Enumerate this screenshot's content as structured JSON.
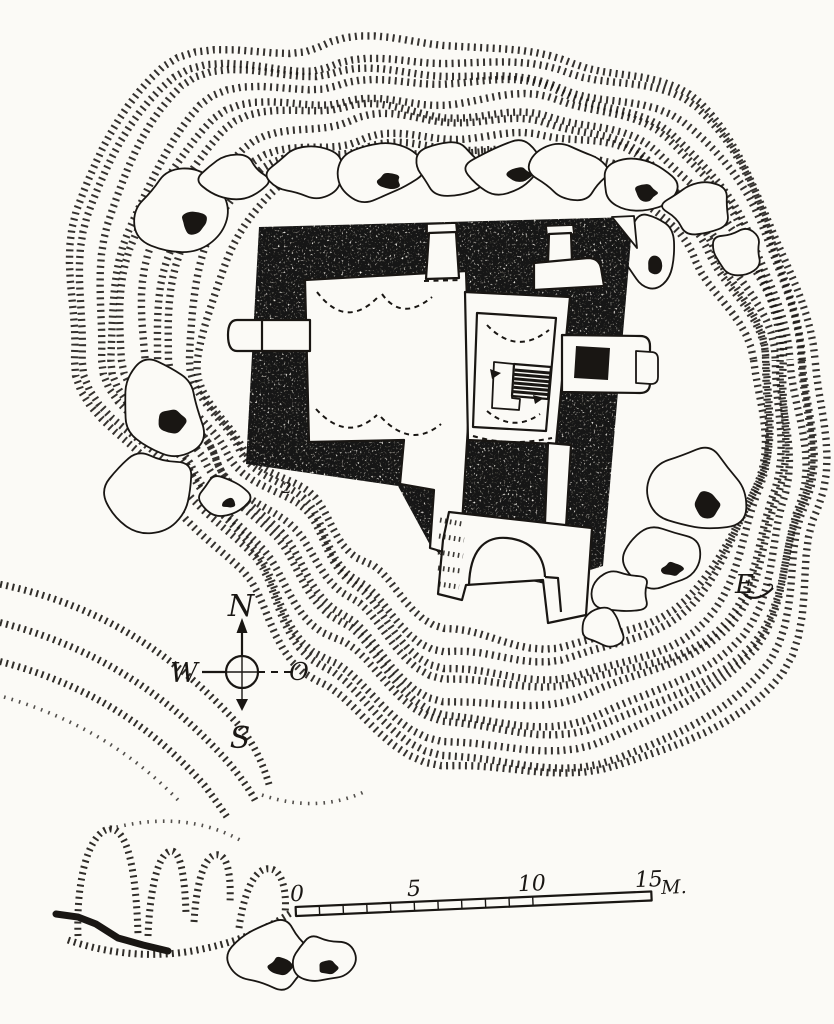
{
  "palette": {
    "paper": "#fbfaf6",
    "ink": "#191613"
  },
  "compass": {
    "north": "N",
    "east": "O",
    "south": "S",
    "west": "W"
  },
  "scale_bar": {
    "labels": [
      "0",
      "5",
      "10",
      "15"
    ],
    "unit": "M.",
    "total_m": 15
  },
  "annotations": {
    "site_label": "2",
    "monogram": "E"
  },
  "map_data": {
    "rings": {
      "cx": 450,
      "cy": 360,
      "count": 10,
      "inner": [
        300,
        322,
        328,
        300,
        268,
        210,
        185,
        215,
        245,
        240,
        235,
        205,
        192,
        212,
        240,
        265
      ],
      "outer": [
        368,
        400,
        466,
        452,
        425,
        358,
        305,
        315,
        390,
        420,
        430,
        350,
        318,
        332,
        370,
        362
      ]
    },
    "terrace": [
      {
        "c": "hach",
        "d": "M -6 583 C 90 602 165 645 236 722 C 252 740 263 762 270 788"
      },
      {
        "c": "hach",
        "d": "M -6 621 C 85 643 162 688 228 762 C 240 776 250 790 256 802"
      },
      {
        "c": "hach",
        "d": "M -6 660 C 75 680 145 718 205 786 C 213 797 221 808 227 817"
      },
      {
        "c": "dot",
        "d": "M 4 697 C 65 715 125 745 178 800"
      },
      {
        "c": "dot",
        "d": "M 262 795 C 300 808 336 806 368 790"
      },
      {
        "c": "hach",
        "d": "M 78 936 C 76 876 90 832 109 829 C 128 827 136 872 138 934"
      },
      {
        "c": "hach",
        "d": "M 148 936 C 150 886 159 852 171 851 C 181 850 185 880 186 914"
      },
      {
        "c": "hach",
        "d": "M 194 922 C 197 874 207 852 219 855 C 229 857 231 882 230 902"
      },
      {
        "c": "hach",
        "d": "M 239 928 C 245 886 257 866 271 869 C 283 871 287 894 285 914"
      },
      {
        "c": "hach",
        "d": "M 68 940 C 108 954 152 958 192 951 C 232 944 262 932 292 912"
      },
      {
        "c": "dot",
        "d": "M 109 829 C 150 818 196 816 240 840"
      },
      {
        "c": "blk",
        "d": "M 56 914 L 78 917 L 96 924 L 118 938 L 143 945 L 168 951"
      }
    ],
    "boulders": [
      {
        "cx": 182,
        "cy": 210,
        "rx": 48,
        "ry": 42,
        "seed": 11,
        "dark": true
      },
      {
        "cx": 236,
        "cy": 180,
        "rx": 34,
        "ry": 24,
        "seed": 22,
        "dark": false
      },
      {
        "cx": 305,
        "cy": 174,
        "rx": 36,
        "ry": 26,
        "seed": 33,
        "dark": false
      },
      {
        "cx": 378,
        "cy": 172,
        "rx": 42,
        "ry": 30,
        "seed": 44,
        "dark": true
      },
      {
        "cx": 448,
        "cy": 167,
        "rx": 38,
        "ry": 27,
        "seed": 55,
        "dark": false
      },
      {
        "cx": 509,
        "cy": 166,
        "rx": 40,
        "ry": 29,
        "seed": 66,
        "dark": true
      },
      {
        "cx": 573,
        "cy": 172,
        "rx": 40,
        "ry": 28,
        "seed": 77,
        "dark": false
      },
      {
        "cx": 636,
        "cy": 184,
        "rx": 38,
        "ry": 30,
        "seed": 88,
        "dark": true
      },
      {
        "cx": 697,
        "cy": 206,
        "rx": 34,
        "ry": 28,
        "seed": 99,
        "dark": false
      },
      {
        "cx": 737,
        "cy": 251,
        "rx": 26,
        "ry": 22,
        "seed": 110,
        "dark": false
      },
      {
        "cx": 648,
        "cy": 255,
        "rx": 25,
        "ry": 36,
        "seed": 112,
        "dark": true
      },
      {
        "cx": 160,
        "cy": 405,
        "rx": 48,
        "ry": 50,
        "seed": 121,
        "dark": true
      },
      {
        "cx": 152,
        "cy": 490,
        "rx": 42,
        "ry": 40,
        "seed": 132,
        "dark": false
      },
      {
        "cx": 223,
        "cy": 497,
        "rx": 25,
        "ry": 20,
        "seed": 143,
        "dark": true
      },
      {
        "cx": 694,
        "cy": 490,
        "rx": 52,
        "ry": 48,
        "seed": 154,
        "dark": true
      },
      {
        "cx": 664,
        "cy": 560,
        "rx": 36,
        "ry": 30,
        "seed": 165,
        "dark": true
      },
      {
        "cx": 621,
        "cy": 593,
        "rx": 30,
        "ry": 24,
        "seed": 176,
        "dark": false
      },
      {
        "cx": 271,
        "cy": 956,
        "rx": 40,
        "ry": 34,
        "seed": 187,
        "dark": true
      },
      {
        "cx": 321,
        "cy": 960,
        "rx": 30,
        "ry": 26,
        "seed": 198,
        "dark": true
      },
      {
        "cx": 601,
        "cy": 627,
        "rx": 24,
        "ry": 19,
        "seed": 209,
        "dark": false
      }
    ],
    "structure": [
      {
        "c": "dark",
        "d": "M 259 227 L 633 217 L 603 566 L 545 584 L 448 562 L 430 545 L 398 486 L 246 464 Z"
      },
      {
        "c": "white",
        "d": "M 612 217 L 634 216 L 637 248 Z"
      },
      {
        "c": "room",
        "d": "M 305 280 L 466 271 L 471 421 L 468 426 L 460 557 L 430 548 L 434 490 L 400 484 L 404 440 L 309 442 Z"
      },
      {
        "c": "dash",
        "d": "M 317 292 Q 346 330 378 297"
      },
      {
        "c": "dash",
        "d": "M 382 294 Q 402 322 432 297"
      },
      {
        "c": "dash",
        "d": "M 316 409 Q 347 443 377 415"
      },
      {
        "c": "dash",
        "d": "M 381 417 Q 411 449 441 424"
      },
      {
        "c": "room",
        "d": "M 465 292 L 570 297 L 556 444 L 468 440 Z"
      },
      {
        "c": "line",
        "d": "M 477 313 L 556 318 L 546 431 L 473 427 Z"
      },
      {
        "c": "dash",
        "d": "M 487 325 Q 516 356 549 330"
      },
      {
        "c": "dash",
        "d": "M 487 411 Q 513 433 540 414"
      },
      {
        "c": "dash",
        "d": "M 473 436 Q 510 447 552 438"
      },
      {
        "c": "white",
        "d": "M 494 362 L 514 364 L 512 398 L 520 399 L 519 410 L 492 408 Z"
      },
      {
        "c": "line",
        "d": "M 514 364 L 551 367 L 548 399 L 512 396 Z"
      },
      {
        "c": "rung",
        "d": "M 514.7 370 L 549.7 373 M 514.4 374.4 L 549.4 377.4 M 514.1 378.7 L 549.1 381.7 M 513.9 383 L 548.9 386 M 513.6 387.3 L 548.6 390.3 M 513.3 391.6 L 548.3 394.6"
      },
      {
        "c": "fillink",
        "d": "M 490 369 L 501 373 L 492 379 Z"
      },
      {
        "c": "fillink",
        "d": "M 533 395 L 544 398 L 535 404 Z"
      },
      {
        "c": "room",
        "d": "M 548 443 L 571 445 L 566 527 L 545 523 Z"
      },
      {
        "c": "room",
        "d": "M 449 512 L 592 528 L 586 615 L 548 623 L 543 580 L 466 585 L 462 600 L 438 594 L 443 540 Z"
      },
      {
        "c": "line",
        "d": "M 469 585 C 470 551 484 536 507 538 C 529 540 544 553 545 577"
      },
      {
        "c": "line",
        "d": "M 545 577 L 558 578 L 561 612"
      },
      {
        "c": "hachthin",
        "d": "M 440 520 L 462 524 M 439 536 L 464 540 M 438 552 L 463 556 M 438 568 L 461 571 M 439 584 L 459 587"
      },
      {
        "c": "room",
        "d": "M 562 335 L 640 336 Q 650 336 650 346 L 650 383 Q 650 393 640 393 L 562 392 Z"
      },
      {
        "c": "darkplain",
        "d": "M 576 346 L 610 348 L 608 380 L 574 378 Z"
      },
      {
        "c": "white",
        "d": "M 636 351 L 651 352 Q 658 352 658 359 L 658 377 Q 658 384 651 384 L 636 383 Z"
      },
      {
        "c": "room",
        "d": "M 237 320 L 310 320 L 310 351 L 237 351 Q 228 351 228 335 Q 228 320 237 320 Z"
      },
      {
        "c": "line",
        "d": "M 262 321 L 262 350"
      },
      {
        "c": "white",
        "d": "M 427 224 L 456 223 L 457 233 L 427 234 Z"
      },
      {
        "c": "room",
        "d": "M 429 233 L 456 232 L 459 278 L 426 279 Z"
      },
      {
        "c": "dash",
        "d": "M 424 281 L 461 280"
      },
      {
        "c": "white",
        "d": "M 546 226 L 573 225 L 574 234 L 547 235 Z"
      },
      {
        "c": "room",
        "d": "M 549 234 L 571 233 L 572 262 L 548 263 Z"
      },
      {
        "c": "room",
        "d": "M 534 263 L 588 258 Q 599 258 601 268 L 604 286 L 534 290 Z"
      }
    ]
  }
}
